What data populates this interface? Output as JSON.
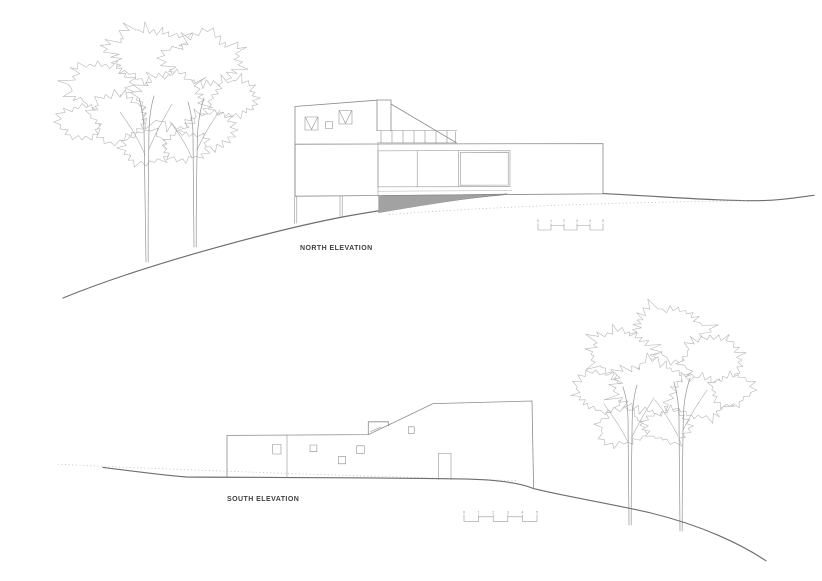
{
  "sheet": {
    "type": "architectural-elevations",
    "background": "#ffffff"
  },
  "north": {
    "label": "NORTH ELEVATION"
  },
  "south": {
    "label": "SOUTH ELEVATION"
  },
  "scale_bar": {
    "ticks": [
      "0",
      "1",
      "2",
      "3",
      "4",
      "5"
    ]
  },
  "colors": {
    "line": "#8a8a8a",
    "terrain": "#6e6e6e",
    "shadow": "#a2a2a2",
    "foliage": "#b6b6b6",
    "trunk": "#9a9a9a",
    "dotted": "#bcbcbc",
    "text": "#3f3f3f",
    "bar": "#9a9a9a",
    "bg": "#ffffff"
  }
}
